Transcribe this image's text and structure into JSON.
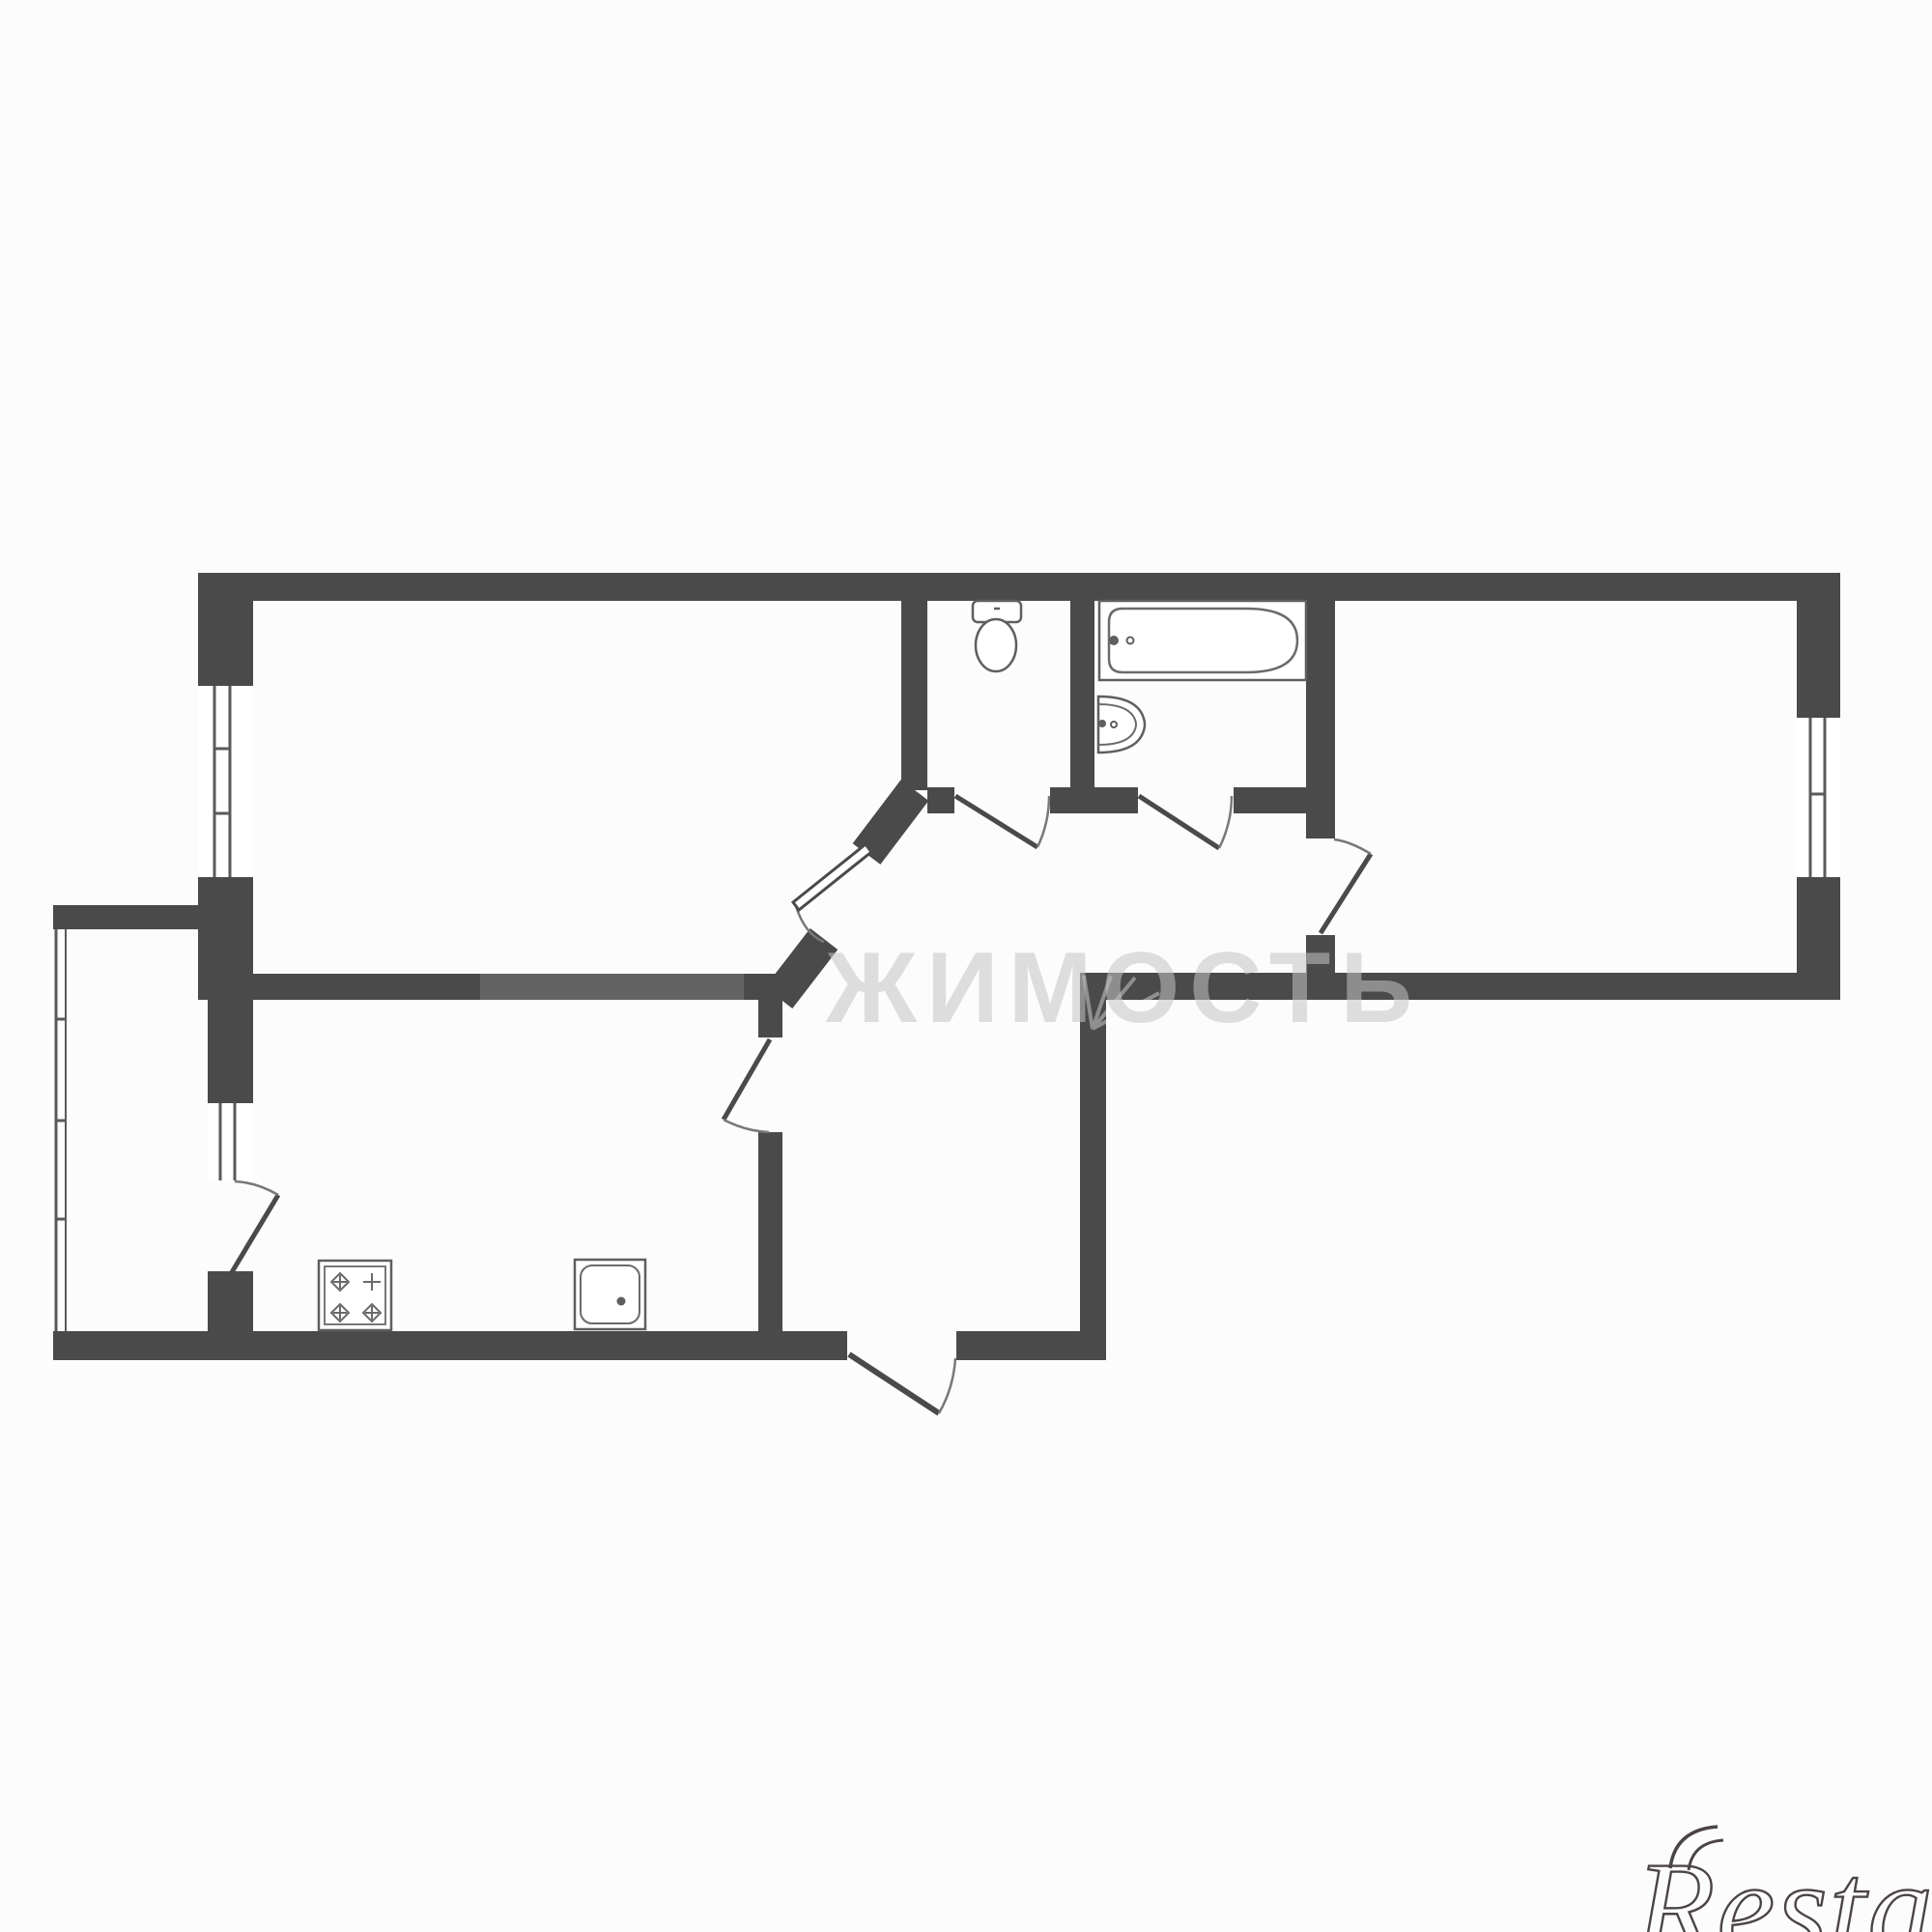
{
  "page": {
    "background_color": "#fcfcfc"
  },
  "floorplan": {
    "wall_color": "#4a4a4a",
    "fixture_line_color": "#5f5f5f",
    "door_arc_color": "#787878",
    "window_glass_color": "#5a5a5a",
    "rooms_depicted": [
      "top-left-room",
      "top-right-room",
      "wc",
      "bathroom",
      "kitchen",
      "hallway",
      "balcony"
    ],
    "fixtures_depicted": [
      "toilet",
      "bathtub",
      "wash-basin",
      "stove-4-burners",
      "kitchen-sink"
    ]
  },
  "watermark": {
    "center_text": "ЖИМОСТЬ",
    "center_color": "#c5c5c5",
    "brand_text": "Restate",
    "brand_color": "#4b4444"
  }
}
